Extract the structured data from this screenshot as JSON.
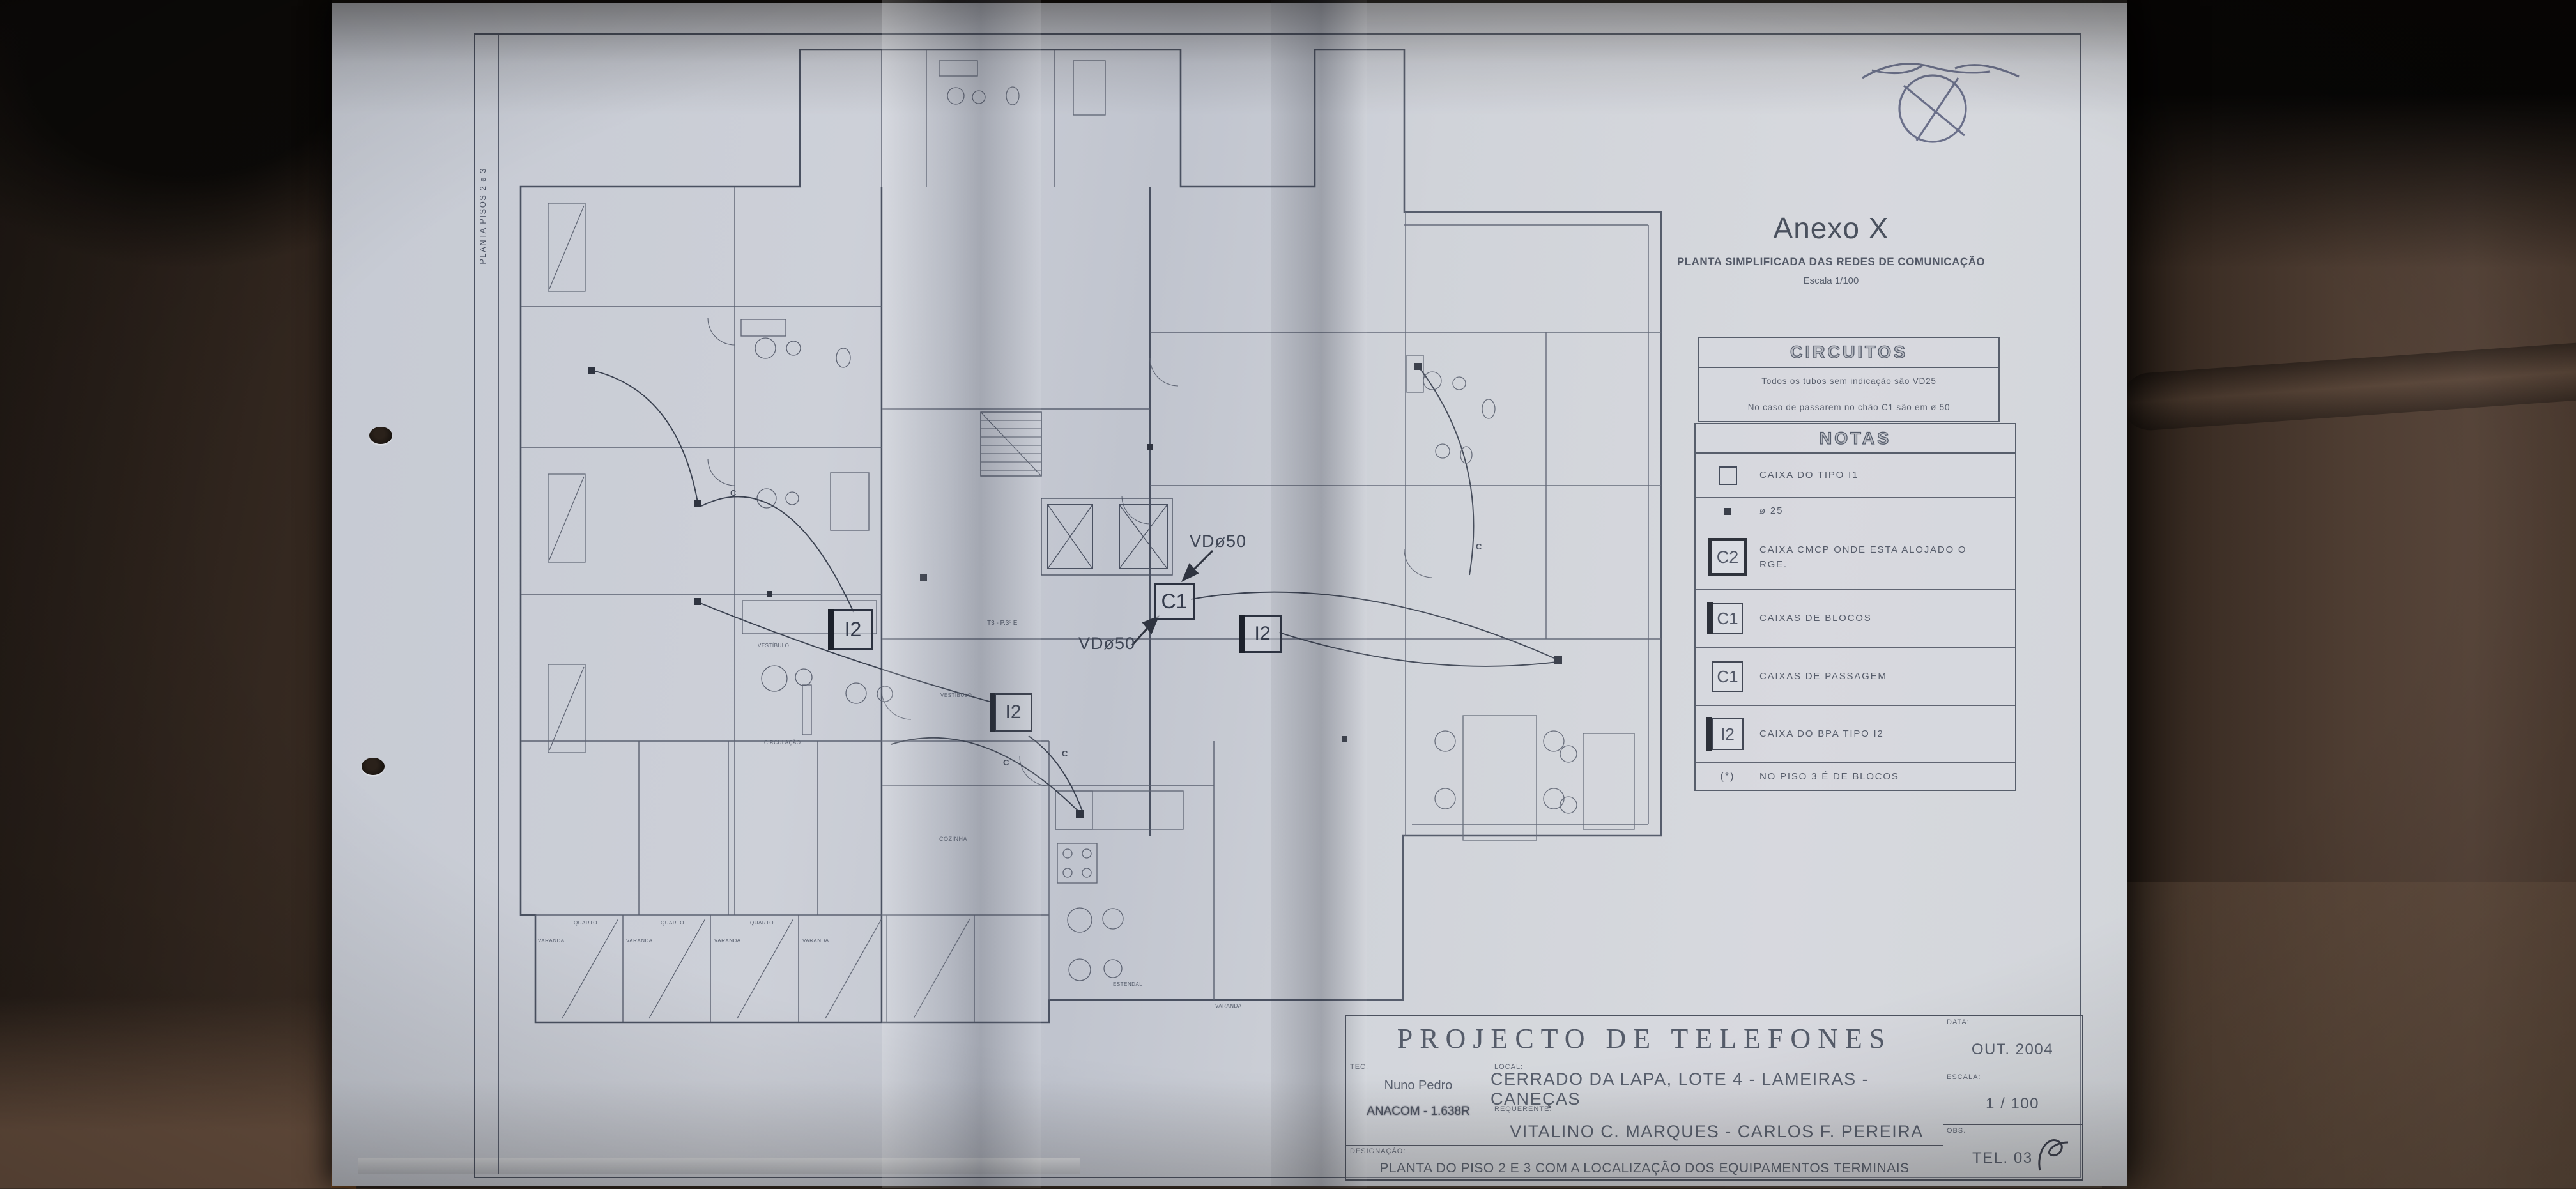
{
  "scene": {
    "colors": {
      "leather_dark": "#241c16",
      "leather_mid": "#4e3d31",
      "leather_light": "#6b5647",
      "paper": "#ccd0d7",
      "ink": "#4a5161",
      "signature_ink": "#3a4165",
      "accent_sliver": "#b06f33"
    }
  },
  "drawing": {
    "side_label": "PLANTA PISOS 2 e 3",
    "header": {
      "title": "Anexo X",
      "subtitle": "PLANTA SIMPLIFICADA DAS REDES DE COMUNICAÇÃO",
      "scale": "Escala 1/100"
    },
    "circuitos": {
      "title": "CIRCUITOS",
      "line1": "Todos os tubos sem indicação são VD25",
      "line2": "No caso de passarem no chão C1 são em ø 50"
    },
    "notas": {
      "title": "NOTAS",
      "items": [
        {
          "symbol_text": "",
          "label": "CAIXA DO TIPO I1"
        },
        {
          "symbol_text": "",
          "label": "ø 25"
        },
        {
          "symbol_text": "C2",
          "label": "CAIXA CMCP ONDE ESTA ALOJADO O RGE."
        },
        {
          "symbol_text": "C1",
          "label": "CAIXAS DE BLOCOS"
        },
        {
          "symbol_text": "C1",
          "label": "CAIXAS DE PASSAGEM"
        },
        {
          "symbol_text": "I2",
          "label": "CAIXA DO BPA TIPO I2"
        }
      ],
      "footnote_symbol": "(*)",
      "footnote_label": "NO PISO 3 É DE BLOCOS"
    },
    "plan": {
      "markers": {
        "c1": "C1",
        "i2_left": "I2",
        "i2_center": "I2",
        "i2_right": "I2",
        "vd50_top": "VDø50",
        "vd50_bottom": "VDø50"
      },
      "circuit_letters": [
        "C",
        "C",
        "C",
        "C"
      ],
      "annotation_t3": "T3 - P.3º E",
      "rooms": {
        "vestibulo_a": "VESTÍBULO",
        "vestibulo_b": "VESTÍBULO",
        "circulacao": "CIRCULAÇÃO",
        "cozinha": "COZINHA",
        "estendal": "ESTENDAL",
        "quartos": [
          "QUARTO",
          "QUARTO",
          "QUARTO"
        ],
        "varandas": [
          "VARANDA",
          "VARANDA",
          "VARANDA",
          "VARANDA",
          "VARANDA"
        ]
      }
    },
    "title_block": {
      "project_title": "PROJECTO DE TELEFONES",
      "tec_label": "TEC.",
      "tec_name": "Nuno Pedro",
      "tec_id": "ANACOM - 1.638R",
      "local_label": "LOCAL:",
      "local_value": "CERRADO DA LAPA, LOTE 4 - LAMEIRAS - CANEÇAS",
      "requerente_label": "REQUERENTE:",
      "requerente_value": "VITALINO C. MARQUES - CARLOS F. PEREIRA",
      "designacao_label": "DESIGNAÇÃO:",
      "designacao_value": "PLANTA DO PISO 2 E 3 COM A LOCALIZAÇÃO DOS EQUIPAMENTOS TERMINAIS",
      "data_label": "DATA:",
      "data_value": "OUT. 2004",
      "escala_label": "ESCALA:",
      "escala_value": "1 / 100",
      "obs_label": "OBS.",
      "obs_value": "TEL. 03"
    }
  }
}
